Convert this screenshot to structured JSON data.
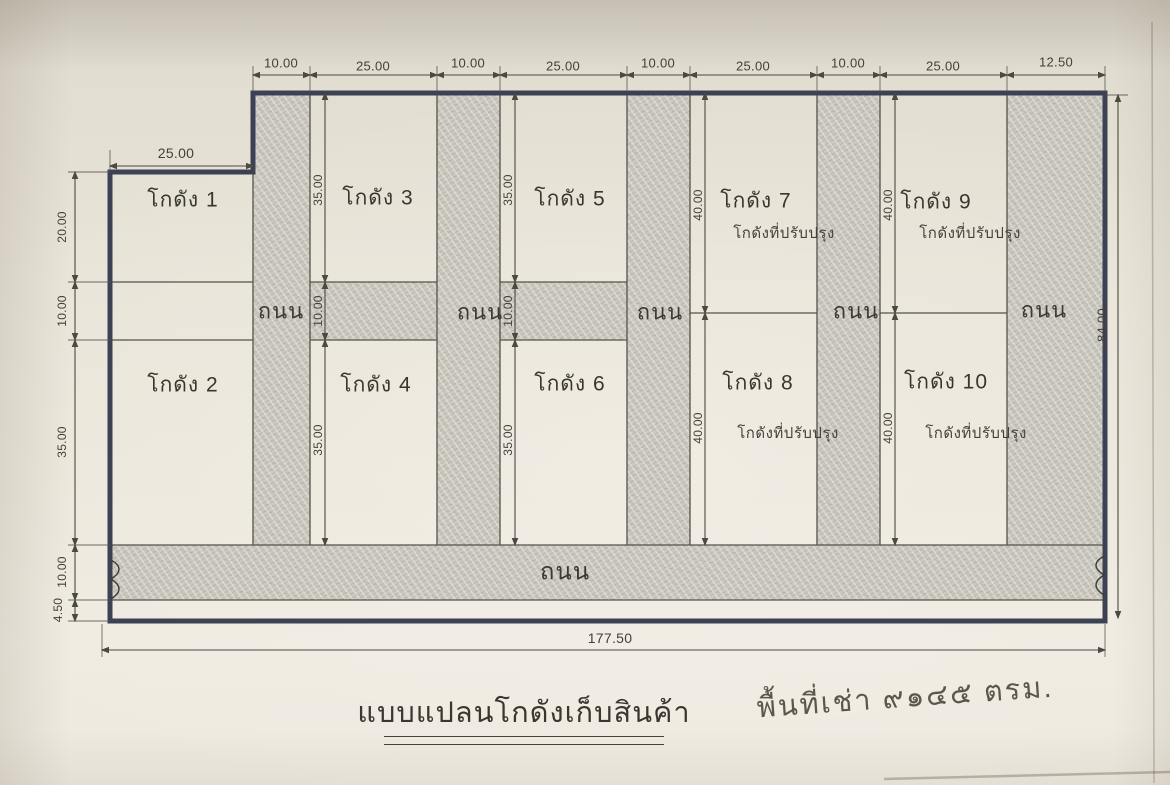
{
  "document": {
    "title": "แบบแปลนโกดังเก็บสินค้า",
    "note": "พื้นที่เช่า ๙๑๔๕ ตรม."
  },
  "labels": {
    "road": "ถนน"
  },
  "warehouses": [
    {
      "name": "โกดัง 1"
    },
    {
      "name": "โกดัง 2"
    },
    {
      "name": "โกดัง 3"
    },
    {
      "name": "โกดัง 4"
    },
    {
      "name": "โกดัง 5"
    },
    {
      "name": "โกดัง 6"
    },
    {
      "name": "โกดัง 7",
      "subtitle": "โกดังที่ปรับปรุง"
    },
    {
      "name": "โกดัง 8",
      "subtitle": "โกดังที่ปรับปรุง"
    },
    {
      "name": "โกดัง 9",
      "subtitle": "โกดังที่ปรับปรุง"
    },
    {
      "name": "โกดัง 10",
      "subtitle": "โกดังที่ปรับปรุง"
    }
  ],
  "dimensions": {
    "top": [
      "10.00",
      "25.00",
      "10.00",
      "25.00",
      "10.00",
      "25.00",
      "10.00",
      "25.00",
      "12.50"
    ],
    "warehouse1_width": "25.00",
    "left": [
      "20.00",
      "10.00",
      "35.00",
      "10.00",
      "4.50"
    ],
    "right_height": "84.00",
    "bottom_width": "177.50",
    "col_3_4": [
      "35.00",
      "10.00",
      "35.00"
    ],
    "col_5_6": [
      "35.00",
      "10.00",
      "35.00"
    ],
    "col_7_8": [
      "40.00",
      "40.00"
    ],
    "col_9_10": [
      "40.00",
      "40.00"
    ]
  },
  "colors": {
    "boundary_ink": "#3d4154",
    "pencil_line": "#55524b",
    "road_fill": "#cbc8bf",
    "paper": "#e9e4d8"
  }
}
